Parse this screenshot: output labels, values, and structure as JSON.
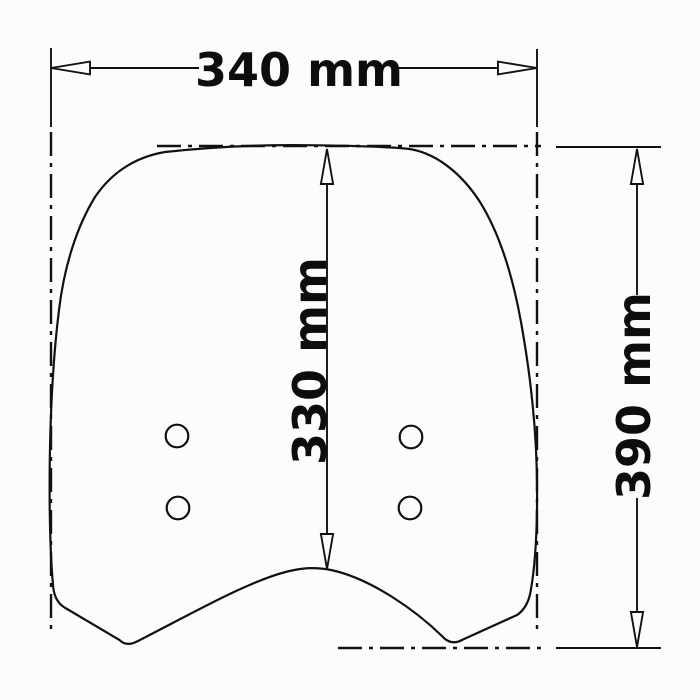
{
  "drawing": {
    "subject": "windscreen-dimension-drawing",
    "dimensions": {
      "width": {
        "label": "340 mm",
        "value": 340,
        "unit": "mm",
        "orientation": "horizontal"
      },
      "screen_height": {
        "label": "330 mm",
        "value": 330,
        "unit": "mm",
        "orientation": "vertical"
      },
      "total_height": {
        "label": "390 mm",
        "value": 390,
        "unit": "mm",
        "orientation": "vertical"
      }
    },
    "mounting_holes": {
      "count": 4
    },
    "colors": {
      "line": "#111111",
      "background": "#fcfcfc",
      "label_text": "#0d0d0d"
    }
  }
}
